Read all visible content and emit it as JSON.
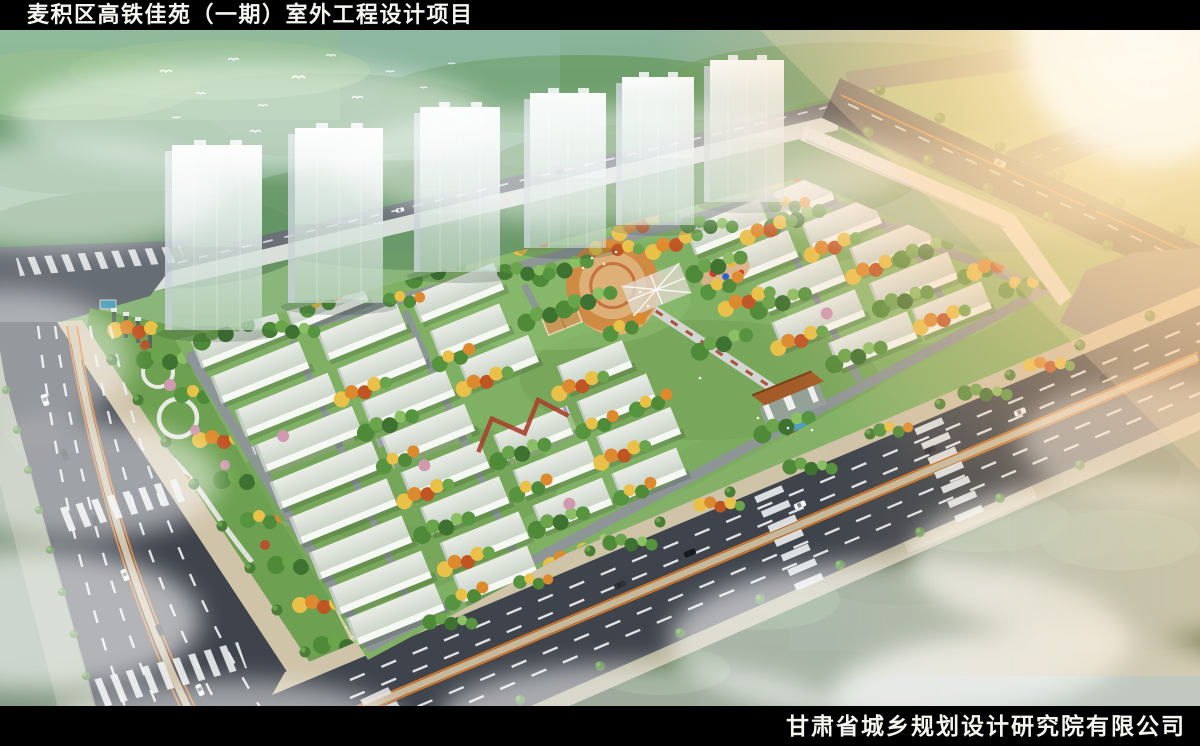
{
  "header": {
    "title": "麦积区高铁佳苑（一期）室外工程设计项目"
  },
  "footer": {
    "company": "甘肃省城乡规划设计研究院有限公司"
  },
  "scene": {
    "tower_count": 6,
    "palette": {
      "bar-bg": "#000000",
      "bar-text": "#f5f5f0",
      "sky-teal": "#9dc3b4",
      "hill-green": "#5d8f55",
      "field-green": "#8cbd6e",
      "sun-warm": "#ffd9a0",
      "road-asphalt": "#3f444c",
      "lane-white": "#e8eaec",
      "lane-orange": "#e0761e",
      "sidewalk-tan": "#cfc3a8",
      "median-tan": "#c8b89a",
      "wall-white": "#e6eae6",
      "tower-side": "#c9d4d8",
      "bldg-white": "#f6f8f3",
      "ground-green": "#7fb063",
      "path-gray": "#8e9499",
      "tree-green": "#57943f",
      "tree-yellow": "#e9c148",
      "tree-orange": "#dd8a2e",
      "tree-red": "#c05524",
      "tree-pink": "#cf9ab0",
      "plaza-orange": "#cf8a44",
      "gate-brown": "#a35c28",
      "water-blue": "#4e9fbe",
      "forest-dark": "#32512e"
    }
  }
}
